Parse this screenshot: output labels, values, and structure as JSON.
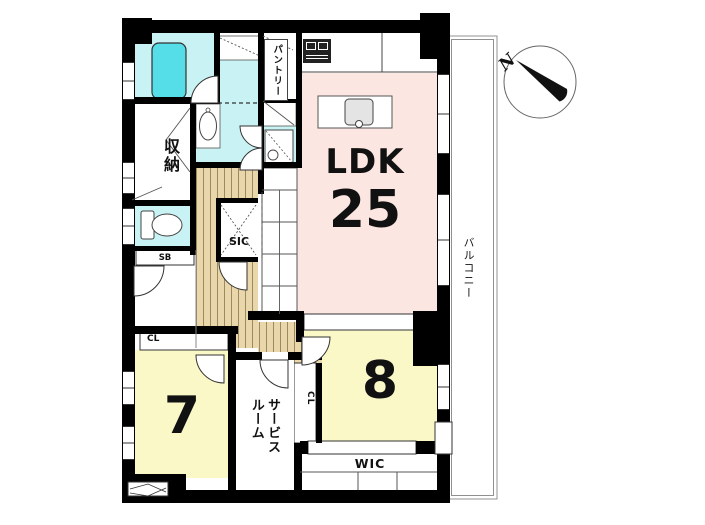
{
  "compass": {
    "label": "N"
  },
  "balcony": {
    "label": "バルコニー"
  },
  "rooms": {
    "ldk": {
      "label": "LDK",
      "size": "25"
    },
    "bedroom_8": {
      "size": "8"
    },
    "bedroom_7": {
      "size": "7"
    },
    "service_room": {
      "label": "サービスルーム"
    },
    "wic": {
      "label": "WIC"
    },
    "sic": {
      "label": "SIC"
    },
    "storage": {
      "label": "収納"
    },
    "pantry": {
      "label": "パントリー"
    },
    "shoe_box": {
      "label": "SB"
    },
    "closet_7": {
      "label": "CL"
    },
    "closet_8": {
      "label": "CL"
    }
  },
  "colors": {
    "ldk_fill": "#fce6e2",
    "bedroom_fill": "#fbf8c8",
    "wet_area_fill": "#c9f2f4",
    "bathtub_fill": "#55dde8",
    "hallway_wood": "#ead6ab",
    "wall": "#000000"
  }
}
